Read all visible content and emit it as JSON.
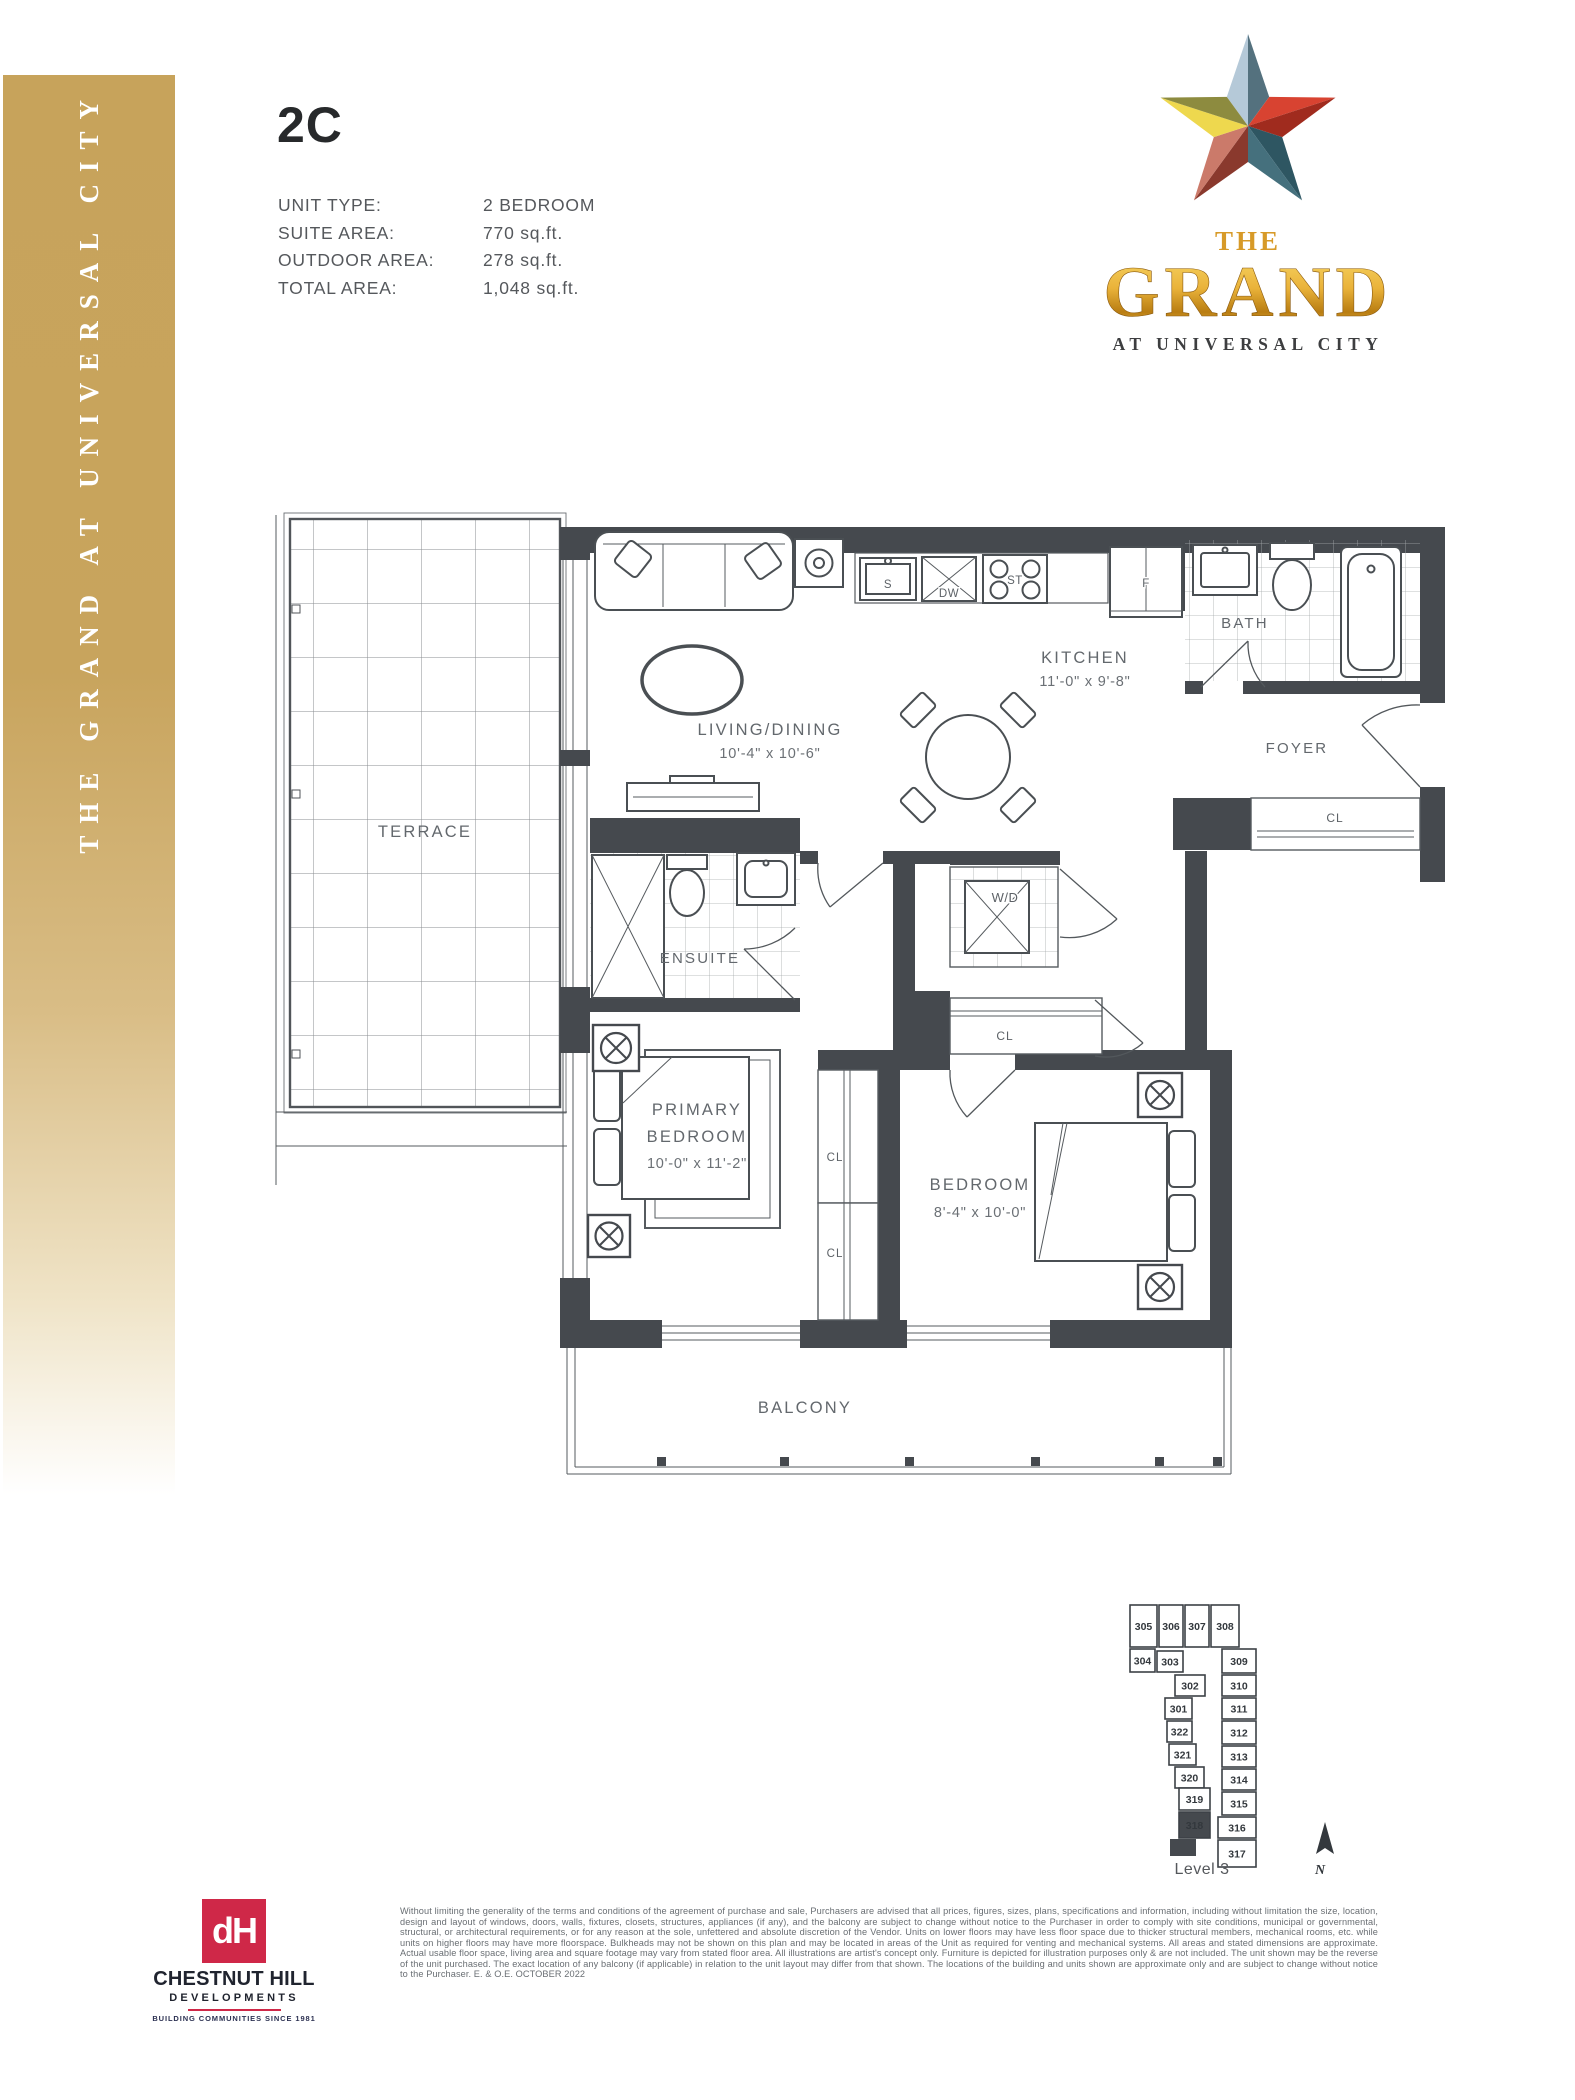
{
  "sidebar": {
    "text": "THE GRAND AT UNIVERSAL CITY"
  },
  "header": {
    "unit_code": "2C",
    "specs": [
      {
        "label": "UNIT TYPE:",
        "value": "2 BEDROOM"
      },
      {
        "label": "SUITE AREA:",
        "value": "770 sq.ft."
      },
      {
        "label": "OUTDOOR AREA:",
        "value": "278 sq.ft."
      },
      {
        "label": "TOTAL AREA:",
        "value": "1,048 sq.ft."
      }
    ]
  },
  "logo": {
    "the": "THE",
    "name": "GRAND",
    "tagline": "AT UNIVERSAL CITY"
  },
  "colors": {
    "sidebar_gold": "#c7a35b",
    "logo_gold": "#d79a28",
    "chestnut_red": "#cf2848",
    "wall": "#45494e"
  },
  "plan": {
    "rooms": {
      "terrace": "TERRACE",
      "living": {
        "name": "LIVING/DINING",
        "dim": "10'-4\" x 10'-6\""
      },
      "kitchen": {
        "name": "KITCHEN",
        "dim": "11'-0\" x 9'-8\""
      },
      "bath": "BATH",
      "foyer": "FOYER",
      "ensuite": "ENSUITE",
      "wd": "W/D",
      "cl": "CL",
      "primary": {
        "line1": "PRIMARY",
        "line2": "BEDROOM",
        "dim": "10'-0\" x 11'-2\""
      },
      "bedroom": {
        "name": "BEDROOM",
        "dim": "8'-4\" x 10'-0\""
      },
      "balcony": "BALCONY"
    },
    "appliances": {
      "sink": "S",
      "dishwasher": "DW",
      "stove": "ST",
      "fridge": "F"
    }
  },
  "keyplan": {
    "level": "Level 3",
    "compass": "N",
    "highlighted_unit": "318",
    "units": [
      "305",
      "306",
      "307",
      "308",
      "309",
      "310",
      "311",
      "312",
      "313",
      "314",
      "315",
      "316",
      "317",
      "304",
      "303",
      "302",
      "301",
      "322",
      "321",
      "320",
      "319",
      "318"
    ]
  },
  "developer": {
    "monogram": "dH",
    "name": "CHESTNUT HILL",
    "division": "DEVELOPMENTS",
    "tagline": "BUILDING COMMUNITIES SINCE 1981"
  },
  "disclaimer": "Without limiting the generality of the terms and conditions of the agreement of purchase and sale, Purchasers are advised that all prices, figures, sizes, plans, specifications and information, including without limitation the size, location, design and layout of windows, doors, walls, fixtures, closets, structures, appliances (if any), and the balcony are subject to change without notice to the Purchaser in order to comply with site conditions, municipal or governmental, structural, or architectural requirements, or for any reason at the sole, unfettered and absolute discretion of the Vendor. Units on lower floors may have less floor space due to thicker structural members, mechanical rooms, etc. while units on higher floors may have more floorspace. Bulkheads may not be shown on this plan and may be located in areas of the Unit as required for venting and mechanical systems. All areas and stated dimensions are approximate. Actual usable floor space, living area and square footage may vary from stated floor area. All illustrations are artist's concept only. Furniture is depicted for illustration purposes only & are not included. The unit shown may be the reverse of the unit purchased. The exact location of any balcony (if applicable) in relation to the unit layout may differ from that shown. The locations of the building and units shown are approximate only and are subject to change without notice to the Purchaser. E. & O.E. OCTOBER 2022"
}
